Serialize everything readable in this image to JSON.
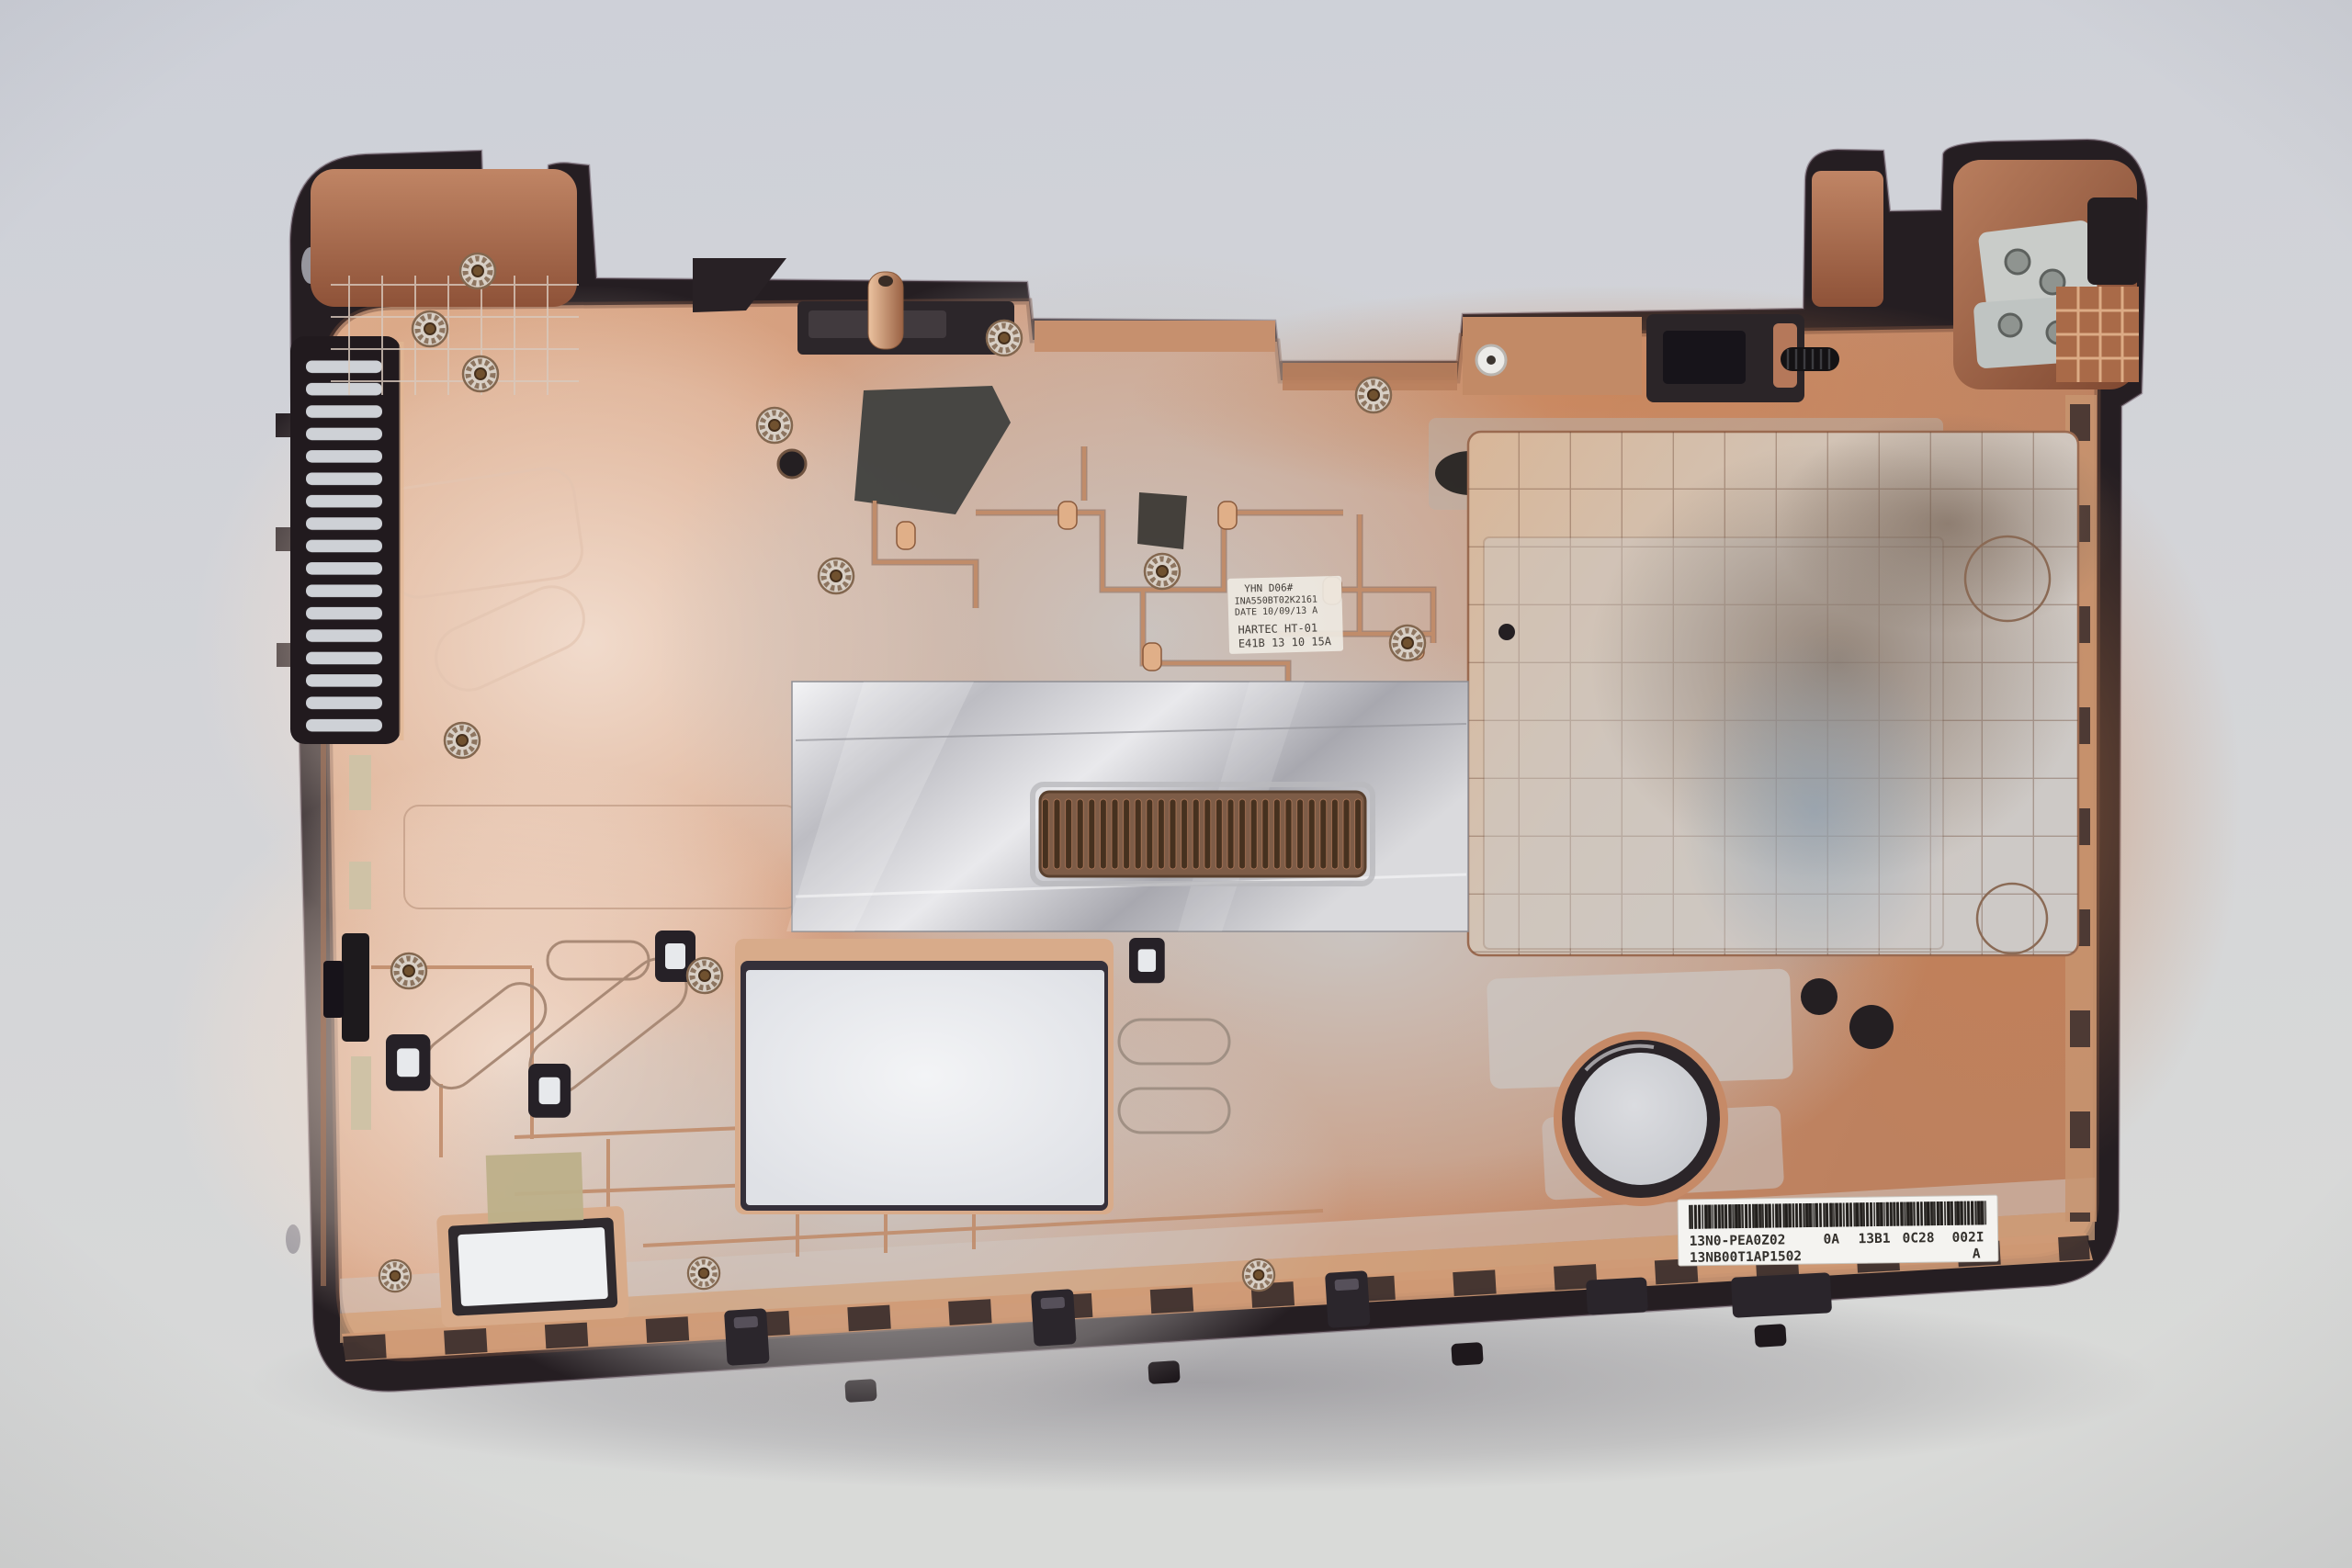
{
  "photo": {
    "subject": "Laptop bottom-case shell, inner side, copper EMI shielding coating on dark plastic, studio backdrop",
    "background_hex": "#d2d4d9",
    "case_plastic_hex": "#251e22",
    "copper_hex": "#cf9775",
    "pale_coating_hex": "#ecd7c8",
    "silver_coating_hex": "#c9c6c3",
    "foil_hex": "#d6d6d9"
  },
  "stamp": {
    "line1": "YHN D06#",
    "line2": "INA550BT02K2161",
    "line3": "DATE 10/09/13 A",
    "line4": "HARTEC HT-01",
    "line5": "E41B 13 10 15A"
  },
  "sticker": {
    "part_number": "13N0-PEA0Z02",
    "col1": "0A",
    "col2": "13B1",
    "col3": "0C28",
    "col4": "002I",
    "serial": "13NB00T1AP1502",
    "revision": "A"
  }
}
